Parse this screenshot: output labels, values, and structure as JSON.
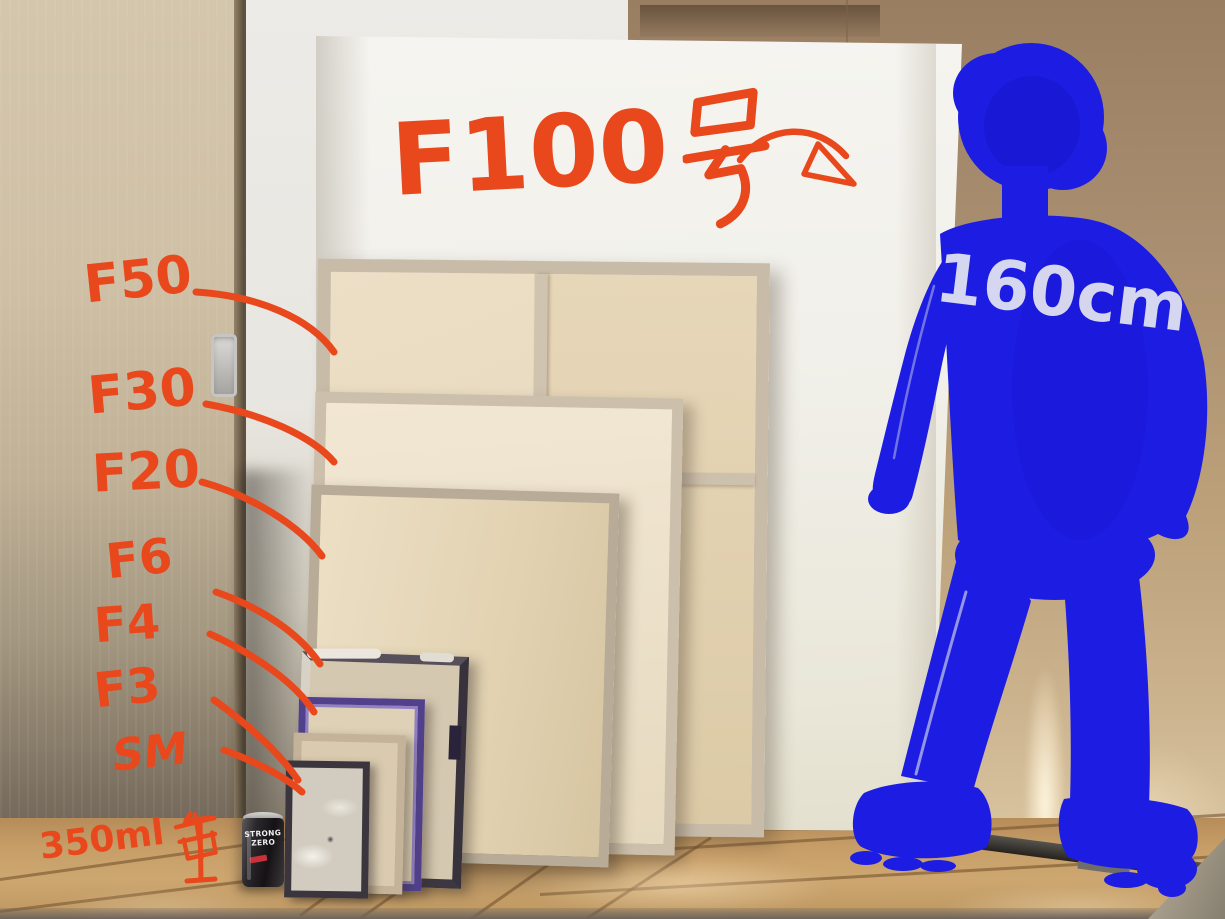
{
  "annotation_color": "#e8481c",
  "figure_color": "#1d1ce2",
  "title_annotation": {
    "text": "F100号",
    "latin": "F100",
    "kanji": "号"
  },
  "size_labels": [
    {
      "id": "f50",
      "text": "F50"
    },
    {
      "id": "f30",
      "text": "F30"
    },
    {
      "id": "f20",
      "text": "F20"
    },
    {
      "id": "f6",
      "text": "F6"
    },
    {
      "id": "f4",
      "text": "F4"
    },
    {
      "id": "f3",
      "text": "F3"
    },
    {
      "id": "sm",
      "text": "SM"
    }
  ],
  "can_annotation": {
    "text": "350ml缶",
    "latin": "350ml",
    "kanji": "缶"
  },
  "height_annotation": {
    "text": "160cm",
    "color": "#e4e5f2"
  },
  "can": {
    "brand_top": "STRONG",
    "brand_bottom": "ZERO"
  },
  "scene_colors": {
    "door": "#cfc0a6",
    "left_wall": "#e9e7e2",
    "right_wall": "#b89c79",
    "floor": "#c79e68",
    "canvas_white": "#f2f1ec",
    "canvas_wood_frame": "#c8bba8"
  }
}
